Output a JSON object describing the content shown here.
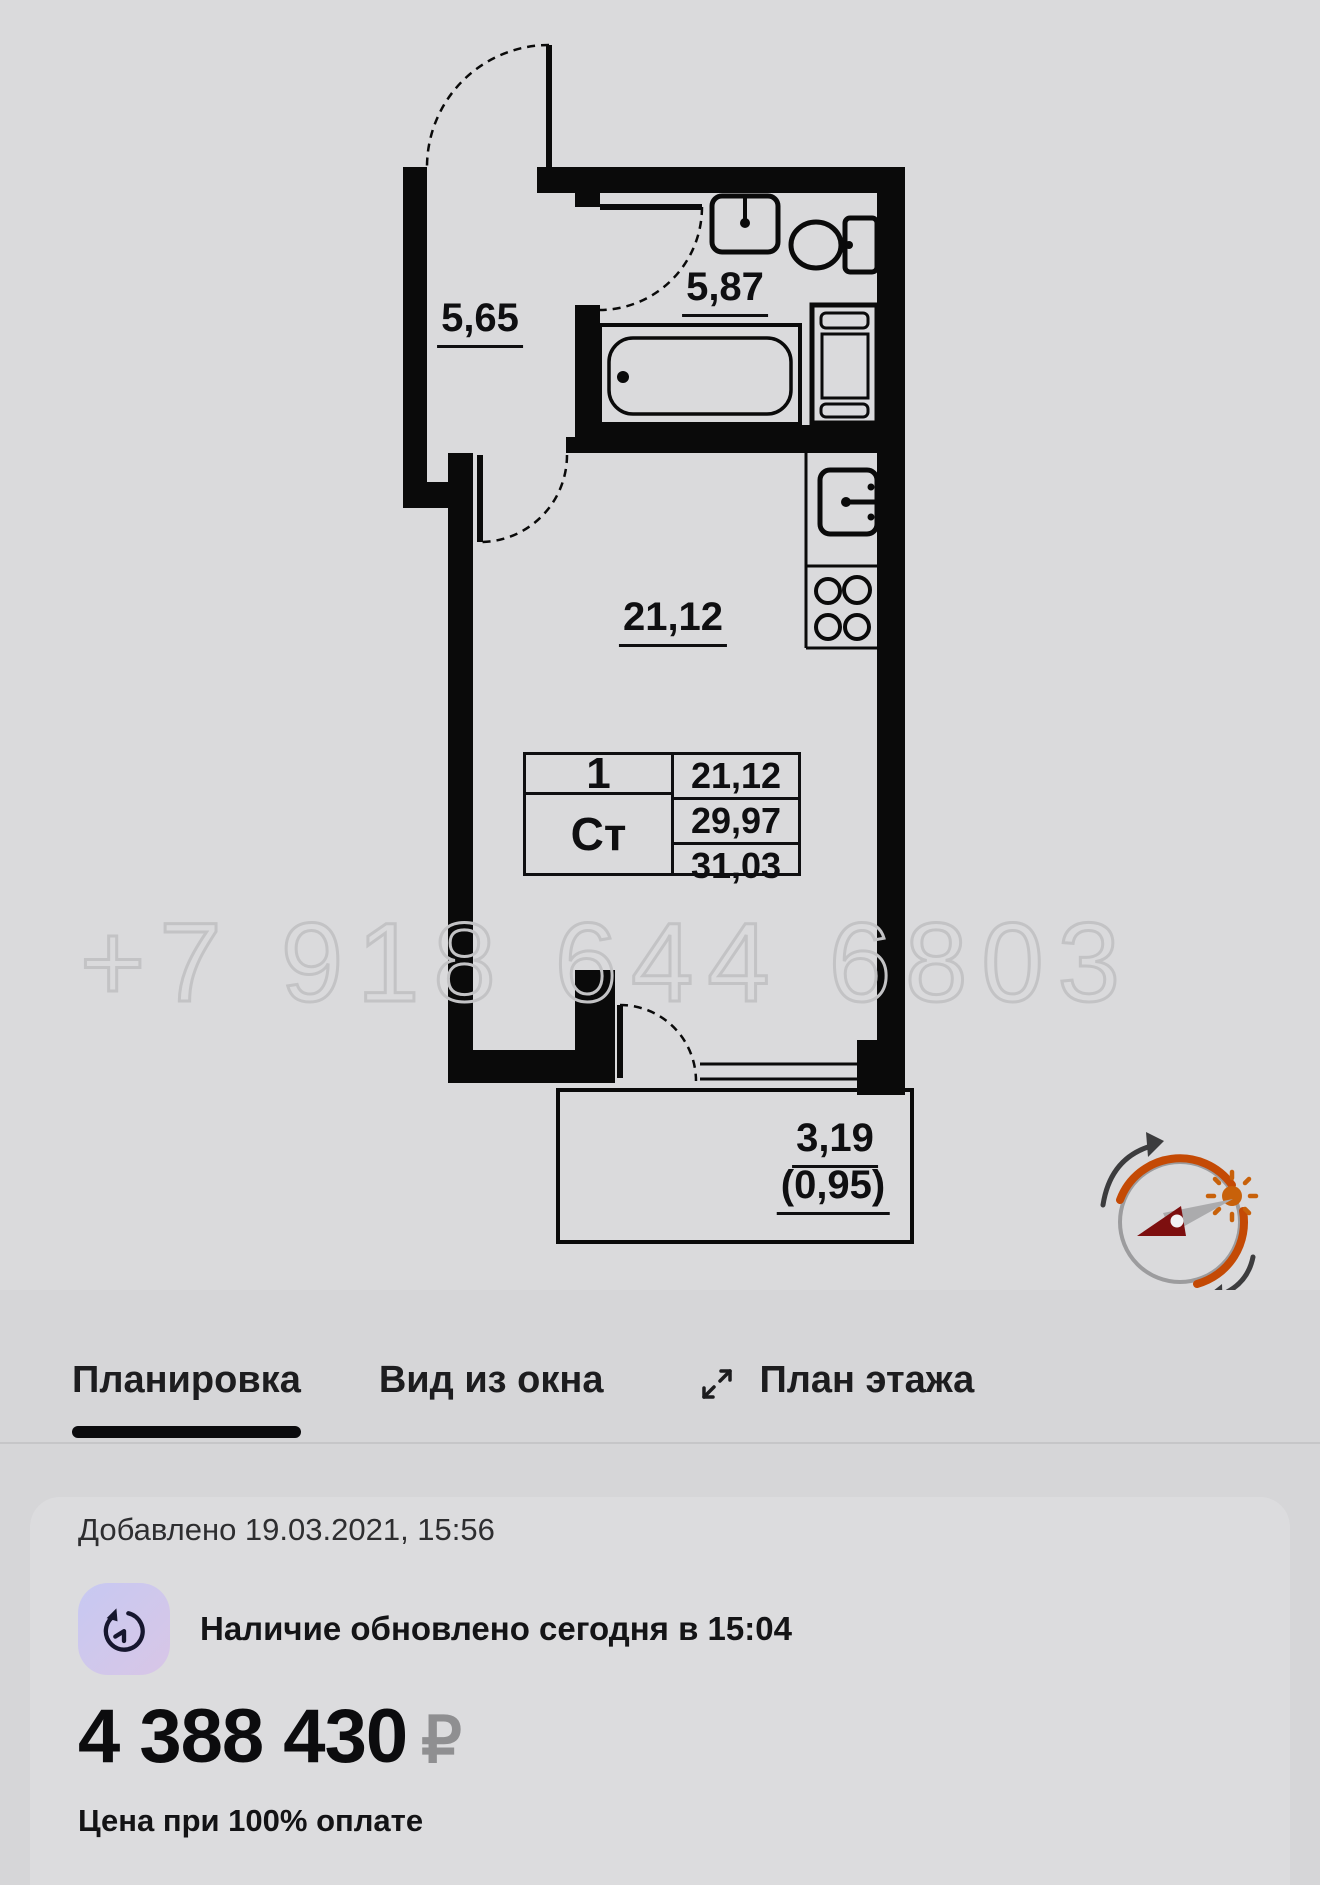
{
  "plan": {
    "watermark": "+7 918 644 6803",
    "labels": {
      "hall": "5,65",
      "bathroom": "5,87",
      "room": "21,12",
      "balcony": "3,19",
      "balcony_coeff": "(0,95)"
    },
    "table": {
      "rooms": "1",
      "type": "Ст",
      "living_area": "21,12",
      "area": "29,97",
      "total_area": "31,03"
    },
    "icons": {
      "compass": "sun-orientation-compass-icon"
    }
  },
  "tabs": [
    {
      "label": "Планировка",
      "active": true
    },
    {
      "label": "Вид из окна",
      "active": false
    },
    {
      "label": "План этажа",
      "active": false,
      "icon": "expand-diagonal-icon"
    }
  ],
  "card": {
    "added": "Добавлено 19.03.2021, 15:56",
    "availability": "Наличие обновлено сегодня в 15:04",
    "price": "4 388 430",
    "currency": "₽",
    "price_note": "Цена при 100% оплате",
    "icons": {
      "availability": "history-clock-icon"
    }
  },
  "colors": {
    "page_bg": "#d6d6d8",
    "plan_bg": "#dadadc",
    "wall": "#0a0a0a",
    "watermark_stroke": "#c3c3c5",
    "compass_orange": "#c44a05",
    "needle_red": "#7d0f0f",
    "price_currency": "#8f8f91"
  }
}
